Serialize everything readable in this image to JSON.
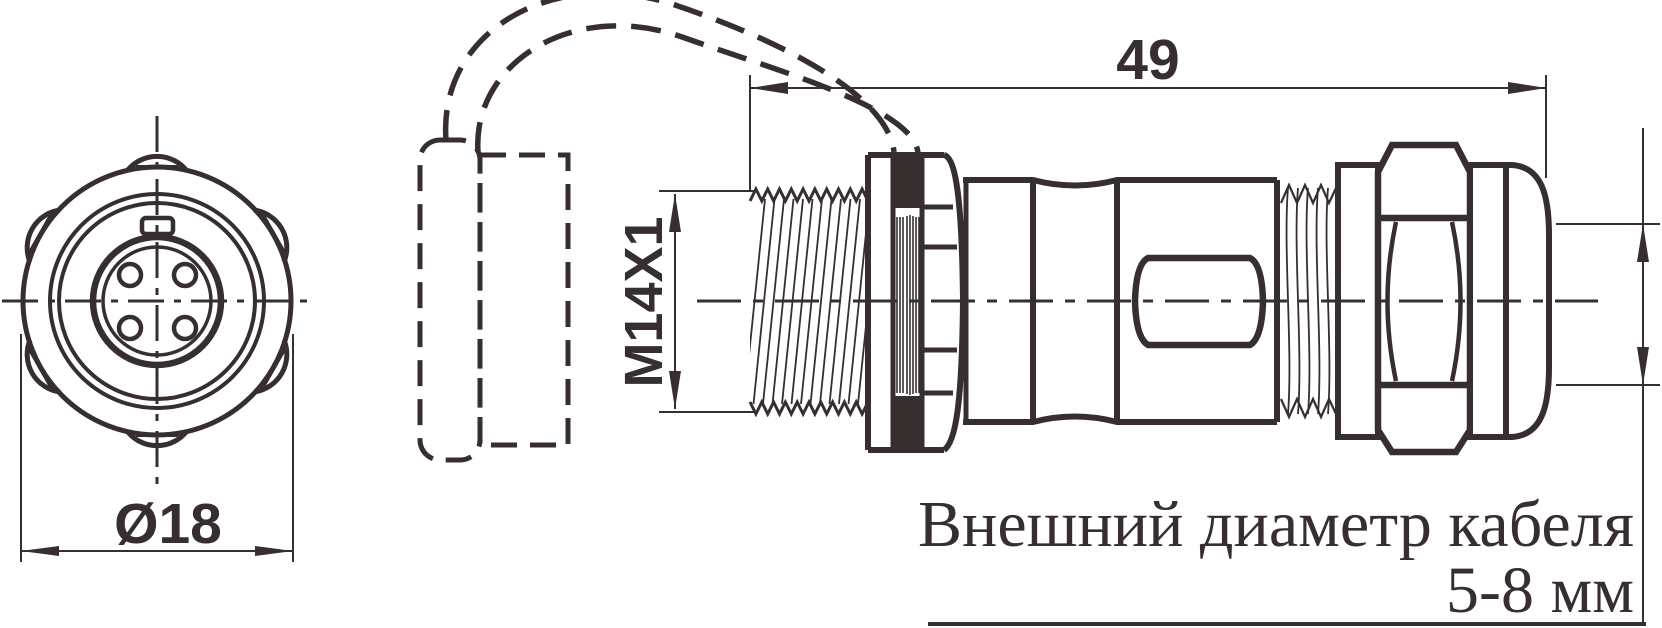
{
  "drawing": {
    "line_color": "#372e30",
    "background": "#ffffff",
    "front_view": {
      "diameter_dim": "Ø18"
    },
    "side_view": {
      "length_dim": "49",
      "thread_dim": "M14X1"
    },
    "note": {
      "line1": "Внешний диаметр кабеля",
      "line2": "5-8 мм"
    }
  }
}
